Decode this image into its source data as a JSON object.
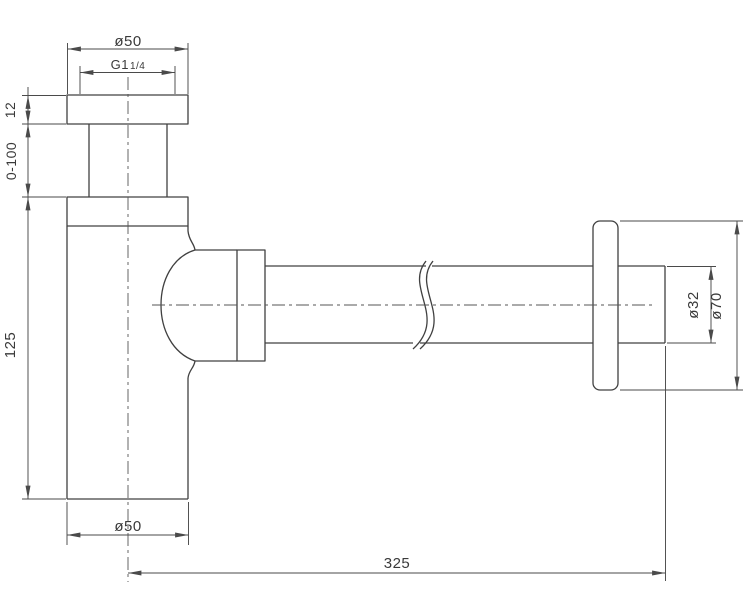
{
  "drawing": {
    "type": "technical-dimension-drawing",
    "subject": "bottle-trap-siphon",
    "colors": {
      "background": "#ffffff",
      "line": "#404040",
      "text": "#3a3a3a"
    }
  },
  "dimensions": {
    "inlet_flange_diameter": {
      "label": "ø50"
    },
    "thread_size": {
      "prefix": "G1",
      "fraction": "1/4"
    },
    "flange_thickness": {
      "label": "12"
    },
    "adjustable_height": {
      "label": "0-100"
    },
    "body_height": {
      "label": "125"
    },
    "body_diameter": {
      "label": "ø50"
    },
    "overall_length": {
      "label": "325"
    },
    "outlet_pipe_diameter": {
      "label": "ø32"
    },
    "wall_flange_diameter": {
      "label": "ø70"
    }
  }
}
